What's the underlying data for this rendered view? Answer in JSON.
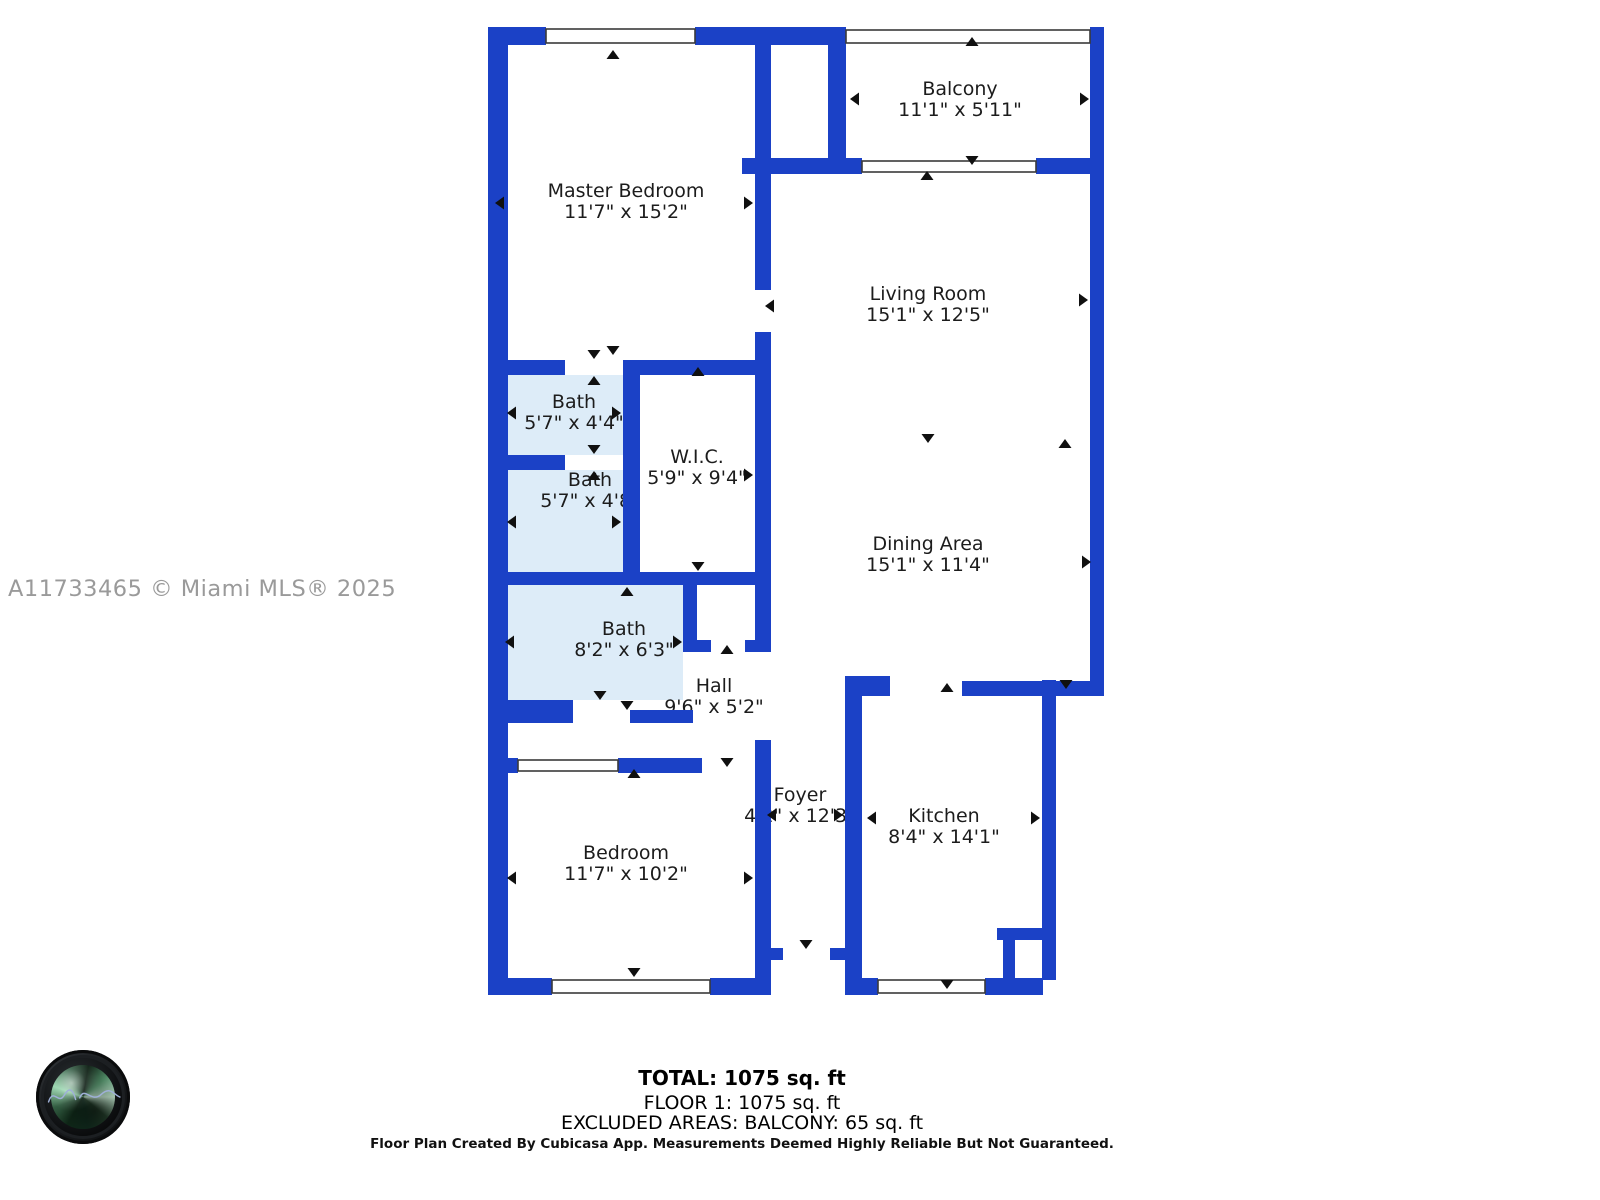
{
  "watermark": "A11733465 © Miami MLS® 2025",
  "rooms": [
    {
      "name": "Master Bedroom",
      "dims": "11'7\" x 15'2\""
    },
    {
      "name": "Balcony",
      "dims": "11'1\" x 5'11\""
    },
    {
      "name": "Living Room",
      "dims": "15'1\" x 12'5\""
    },
    {
      "name": "Bath",
      "dims": "5'7\" x 4'4\""
    },
    {
      "name": "W.I.C.",
      "dims": "5'9\" x 9'4\""
    },
    {
      "name": "Bath",
      "dims": "5'7\" x 4'8\""
    },
    {
      "name": "Dining Area",
      "dims": "15'1\" x 11'4\""
    },
    {
      "name": "Bath",
      "dims": "8'2\" x 6'3\""
    },
    {
      "name": "Hall",
      "dims": "9'6\" x 5'2\""
    },
    {
      "name": "Foyer",
      "dims": "4'2\" x 12'3\""
    },
    {
      "name": "Kitchen",
      "dims": "8'4\" x 14'1\""
    },
    {
      "name": "Bedroom",
      "dims": "11'7\" x 10'2\""
    }
  ],
  "footer": {
    "total": "TOTAL: 1075 sq. ft",
    "floor": "FLOOR 1: 1075 sq. ft",
    "excluded": "EXCLUDED AREAS: BALCONY: 65 sq. ft",
    "disclaimer": "Floor Plan Created By Cubicasa App. Measurements Deemed Highly Reliable But Not Guaranteed."
  },
  "colors": {
    "wall": "#1b41c6",
    "bath_fill": "#ddecf8",
    "text": "#1c1c1c",
    "watermark": "#9a9a9a"
  }
}
